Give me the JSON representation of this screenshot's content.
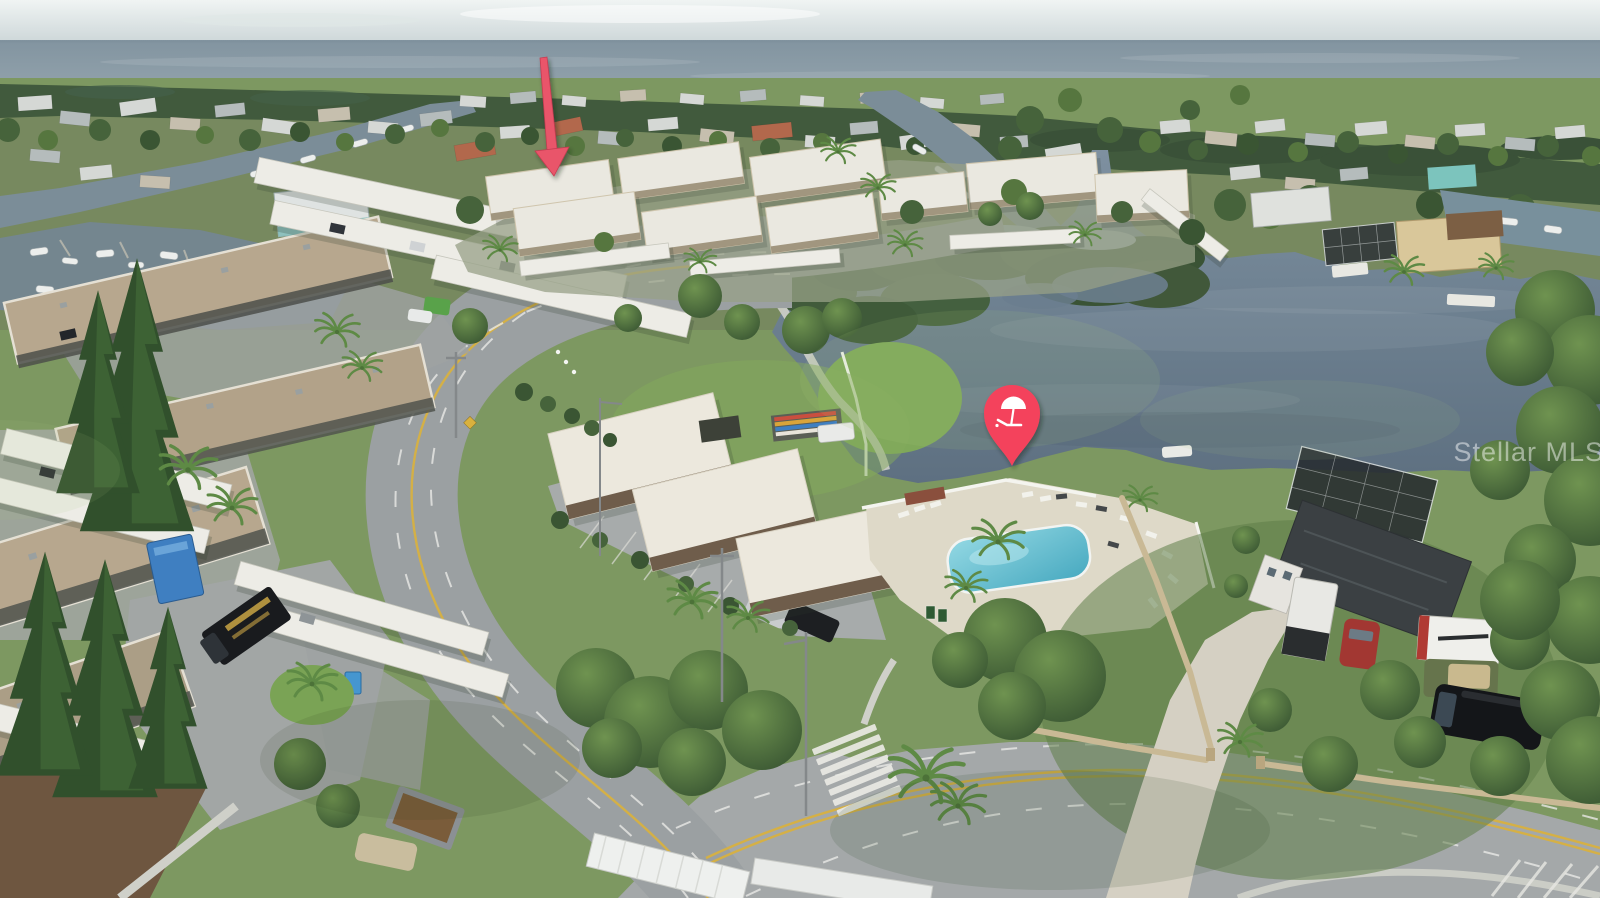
{
  "meta": {
    "kind": "aerial drone real-estate listing photograph",
    "canvas": {
      "width": 1600,
      "height": 898
    },
    "description": "Aerial view of a Gulf-coast waterfront condo community: canals with docked boats, a large brackish lake, community clubhouse with swimming pool and lounge chairs, curved two-lane road meeting a wide boulevard with a zebra crosswalk, condo buildings with carports, mangrove islands at the horizon. A red arrow marks the subject condo building and a red beach-umbrella map pin marks the private waterfront amenity."
  },
  "watermark": {
    "text": "Stellar MLS",
    "color": "#ffffff",
    "opacity": 0.48
  },
  "annotations": {
    "arrow": {
      "role": "points to listed condo building",
      "color": "#e9556b",
      "tail_x": 543,
      "tail_y": 56,
      "tip_x": 553,
      "tip_y": 176
    },
    "pin": {
      "role": "marks lakefront beach amenity",
      "shape": "map-pin",
      "icon": "beach-umbrella-with-lounger",
      "color": "#f4435c",
      "cx": 1012,
      "cy": 413,
      "tip_y": 466
    }
  },
  "palette": {
    "sky": "#e9efee",
    "gulf_water": "#8d9faa",
    "treeline": "#415a3d",
    "upper_land": "#77895f",
    "grass": "#7d9861",
    "lake_water": "#6e8192",
    "canal_water": "#7b8d98",
    "pool_water": "#63bcd2",
    "pool_deck": "#ded9c8",
    "road": "#9ba0a2",
    "boulevard": "#a4a8a9",
    "concrete": "#d5d0c3",
    "roof_white": "#eae8e0",
    "roof_tan": "#b3a48b",
    "roof_dark": "#3b4043",
    "roof_terracotta": "#b2684c",
    "carport_white": "#edece6",
    "lane_yellow": "#d9b13e",
    "lane_white": "#e9e9e6",
    "wall_tan": "#c9b995",
    "pin_red": "#f4435c",
    "arrow_red": "#e9556b"
  },
  "scene": {
    "sky": {
      "label": "overcast sky band at horizon"
    },
    "gulf": {
      "label": "Gulf of Mexico open water"
    },
    "lake": {
      "label": "brackish lake with mangrove shoreline"
    },
    "canals": {
      "label": "residential boat canals with docks and moored boats"
    },
    "pool": {
      "label": "community swimming pool with white deck and lounge chairs"
    },
    "roads": [
      {
        "label": "curved two-lane community road",
        "color": "#9ba0a2"
      },
      {
        "label": "four-lane boulevard with crosswalk",
        "color": "#a4a8a9"
      }
    ],
    "buildings": [
      {
        "label": "left condo complex with tan roofs and white carports",
        "roof_color": "#b3a48b"
      },
      {
        "label": "center condo cluster (subject property)",
        "roof_color": "#eae8e0"
      },
      {
        "label": "clubhouse wings with white roofs and brick fascia",
        "roof_color": "#ece8dd"
      },
      {
        "label": "single-family home with dark hip roof and pool cage",
        "roof_color": "#3b4043"
      }
    ],
    "details": [
      "kayak rack",
      "white pickup truck",
      "black pickup and silver sedan in clubhouse lot",
      "blue cargo trailer",
      "black landscaping truck with gold lettering",
      "white cargo trailers",
      "black van",
      "red car",
      "norfolk pines",
      "palm trees",
      "zebra crosswalk",
      "tan privacy walls",
      "white privacy fence",
      "porta-toilets"
    ]
  }
}
